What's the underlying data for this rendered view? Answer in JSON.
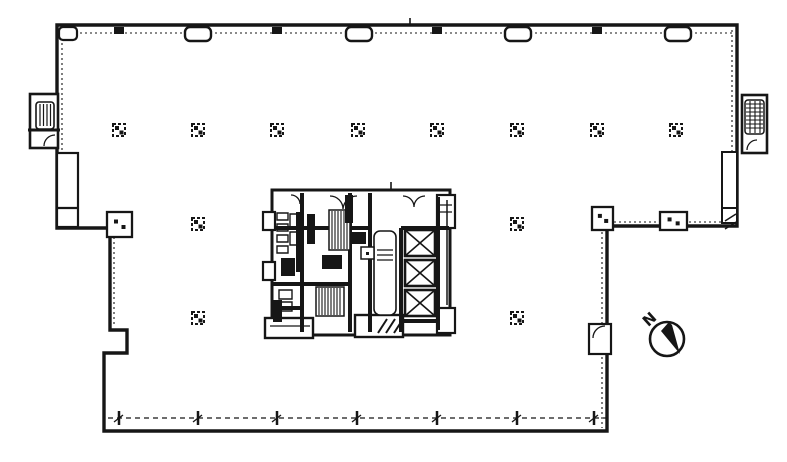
{
  "page": {
    "background": "#ffffff",
    "ink": "#161616"
  },
  "compass": {
    "label": "N"
  },
  "grid": {
    "column_xs": [
      119,
      198,
      277,
      358,
      437,
      517,
      597,
      676
    ],
    "row1_y": 130,
    "row2": {
      "y": 224,
      "xs": [
        198,
        517
      ]
    },
    "row3": {
      "y": 318,
      "xs": [
        198,
        517
      ]
    },
    "top_marker_xs": [
      198,
      359,
      518,
      678
    ],
    "top_tick_xs": [
      119,
      277,
      437,
      597
    ],
    "bottom_mullion_xs": [
      119,
      198,
      277,
      357,
      437,
      517,
      594
    ],
    "wall_boxes": [
      {
        "x": 107,
        "y": 212,
        "w": 25,
        "h": 25
      },
      {
        "x": 592,
        "y": 207,
        "w": 21,
        "h": 23
      },
      {
        "x": 660,
        "y": 212,
        "w": 27,
        "h": 18
      }
    ],
    "lower_right_door_box": {
      "x": 589,
      "y": 324,
      "w": 22,
      "h": 30
    }
  },
  "elevators": {
    "x": 405,
    "w": 30,
    "h": 26,
    "ys": [
      230,
      260,
      290
    ]
  }
}
